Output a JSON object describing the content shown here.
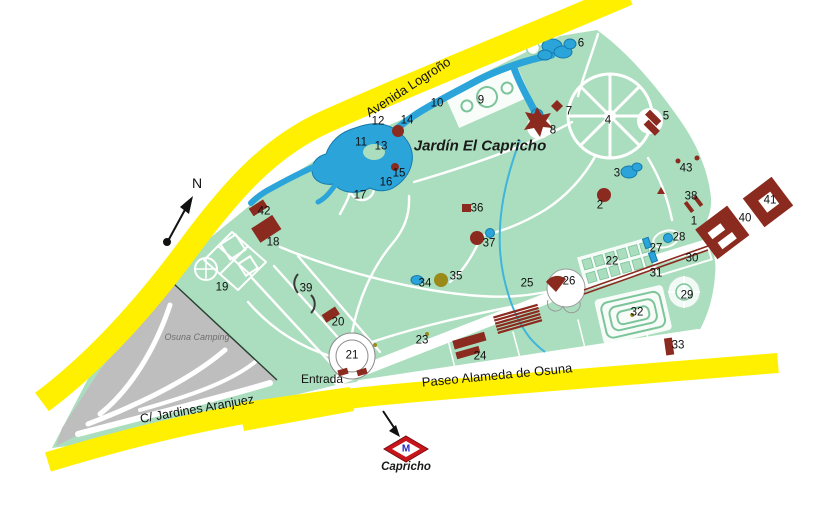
{
  "map": {
    "title": "Jardín El Capricho",
    "compass_label": "N",
    "entrance_label": "Entrada",
    "camping_label": "Osuna Camping",
    "streets": {
      "avenida": "Avenida Logroño",
      "paseo": "Paseo Alameda de Osuna",
      "jardines": "C/ Jardines Aranjuez"
    },
    "metro": {
      "symbol_letter": "M",
      "station_label": "Capricho"
    },
    "colors": {
      "road_yellow": "#FFF000",
      "park_green": "#ABDEBE",
      "hedge_green": "#7CC49A",
      "water_blue": "#2BA4DA",
      "water_dark": "#157AAB",
      "building_red": "#8B2A1F",
      "camping_gray": "#BEBEBE",
      "olive": "#9A8A1A",
      "metro_red": "#C8151B",
      "metro_blue": "#2626C4"
    },
    "markers": [
      {
        "n": "1",
        "x": 694,
        "y": 222
      },
      {
        "n": "2",
        "x": 600,
        "y": 206
      },
      {
        "n": "3",
        "x": 617,
        "y": 174
      },
      {
        "n": "4",
        "x": 608,
        "y": 121
      },
      {
        "n": "5",
        "x": 666,
        "y": 117
      },
      {
        "n": "6",
        "x": 581,
        "y": 44
      },
      {
        "n": "7",
        "x": 569,
        "y": 112
      },
      {
        "n": "8",
        "x": 553,
        "y": 131
      },
      {
        "n": "9",
        "x": 481,
        "y": 101
      },
      {
        "n": "10",
        "x": 437,
        "y": 104
      },
      {
        "n": "11",
        "x": 361,
        "y": 143
      },
      {
        "n": "12",
        "x": 378,
        "y": 122
      },
      {
        "n": "13",
        "x": 381,
        "y": 147
      },
      {
        "n": "14",
        "x": 407,
        "y": 121
      },
      {
        "n": "15",
        "x": 399,
        "y": 174
      },
      {
        "n": "16",
        "x": 386,
        "y": 183
      },
      {
        "n": "17",
        "x": 360,
        "y": 196
      },
      {
        "n": "18",
        "x": 273,
        "y": 243
      },
      {
        "n": "19",
        "x": 222,
        "y": 288
      },
      {
        "n": "20",
        "x": 338,
        "y": 323
      },
      {
        "n": "21",
        "x": 352,
        "y": 356
      },
      {
        "n": "22",
        "x": 612,
        "y": 262
      },
      {
        "n": "23",
        "x": 422,
        "y": 341
      },
      {
        "n": "24",
        "x": 480,
        "y": 357
      },
      {
        "n": "25",
        "x": 527,
        "y": 284
      },
      {
        "n": "26",
        "x": 569,
        "y": 282
      },
      {
        "n": "27",
        "x": 656,
        "y": 249
      },
      {
        "n": "28",
        "x": 679,
        "y": 238
      },
      {
        "n": "29",
        "x": 687,
        "y": 296
      },
      {
        "n": "30",
        "x": 692,
        "y": 259
      },
      {
        "n": "31",
        "x": 656,
        "y": 274
      },
      {
        "n": "32",
        "x": 637,
        "y": 313
      },
      {
        "n": "33",
        "x": 678,
        "y": 346
      },
      {
        "n": "34",
        "x": 425,
        "y": 284
      },
      {
        "n": "35",
        "x": 456,
        "y": 277
      },
      {
        "n": "36",
        "x": 477,
        "y": 209
      },
      {
        "n": "37",
        "x": 489,
        "y": 244
      },
      {
        "n": "38",
        "x": 691,
        "y": 197
      },
      {
        "n": "39",
        "x": 306,
        "y": 289
      },
      {
        "n": "40",
        "x": 745,
        "y": 219
      },
      {
        "n": "41",
        "x": 770,
        "y": 201
      },
      {
        "n": "42",
        "x": 264,
        "y": 212
      },
      {
        "n": "43",
        "x": 686,
        "y": 169
      }
    ]
  }
}
